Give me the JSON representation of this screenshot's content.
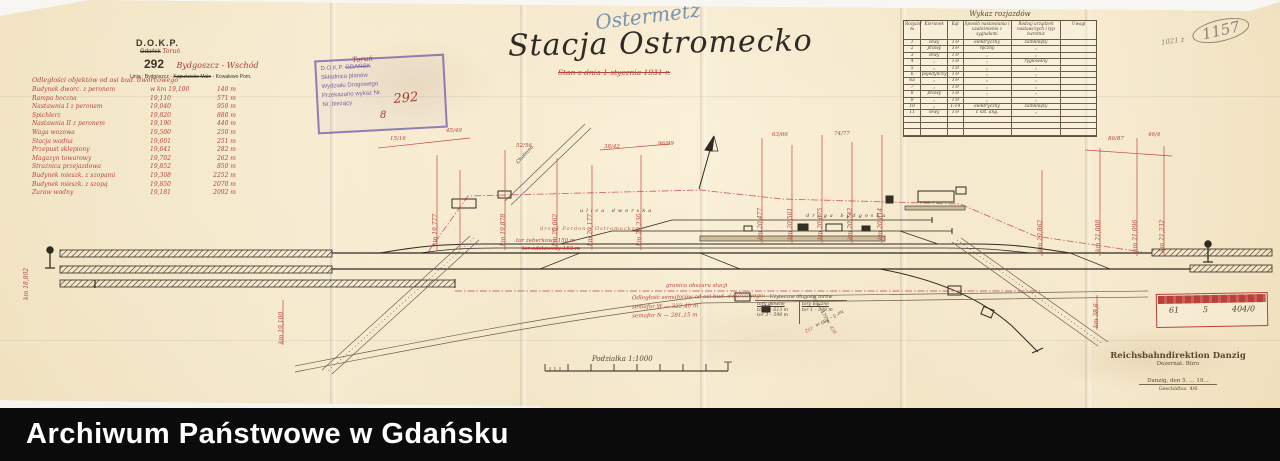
{
  "dokp": {
    "org": "D.O.K.P.",
    "office_old": "Gdańsk",
    "office_new": "Toruń",
    "number": "292",
    "route": "Bydgoszcz - Wschód",
    "line_pre": "Linja : Bydgoszcz -",
    "line_struck": "Kapuścisko Małe",
    "line_post": "- Kowalewo Pom."
  },
  "title": {
    "german": "Ostermetz",
    "main": "Stacja Ostromecko",
    "subtitle": "Stan z dnia 1 stycznia 1931 r."
  },
  "purple_stamp": {
    "l1a": "D.O.K.P.",
    "l1b": "GDAŃSK",
    "l2": "Składnica planów",
    "l3": "Wydziału Drogowego",
    "l4": "Przekazano wykaz Nr.",
    "l5": "Nr. bieżący"
  },
  "archive_note": {
    "prefix": "1021 z",
    "number": "1157"
  },
  "distances": {
    "header": "Odległości objektów od osi bud. dworcowego",
    "rows": [
      {
        "n": "Budynek dworc. z peronem",
        "k": "w km 19,100",
        "m": "140 m"
      },
      {
        "n": "Rampa boczna",
        "k": "19,110",
        "m": "571 m"
      },
      {
        "n": "Nastawnia I z peronem",
        "k": "19,040",
        "m": "950 m"
      },
      {
        "n": "Spichlerz",
        "k": "19,820",
        "m": "880 m"
      },
      {
        "n": "Nastawnia II z peronem",
        "k": "19,190",
        "m": "440 m"
      },
      {
        "n": "Waga wozowa",
        "k": "19,500",
        "m": "250 m"
      },
      {
        "n": "Stacja wodna",
        "k": "19,601",
        "m": "251 m"
      },
      {
        "n": "Przepust sklepiony",
        "k": "19,641",
        "m": "282 m"
      },
      {
        "n": "Magazyn towarowy",
        "k": "19,702",
        "m": "262 m"
      },
      {
        "n": "Strażnica przejazdowa",
        "k": "19,852",
        "m": "850 m"
      },
      {
        "n": "Budynek mieszk. z szopami",
        "k": "19,308",
        "m": "2252 m"
      },
      {
        "n": "Budynek mieszk. z szopą",
        "k": "19,850",
        "m": "2070 m"
      },
      {
        "n": "Żuraw wodny",
        "k": "19,181",
        "m": "2092 m"
      }
    ]
  },
  "turnouts": {
    "title": "Wykaz rozjazdów",
    "columns": [
      "Rozjazd №",
      "Kierunek",
      "Kąt",
      "Sposób nastawiania i uzależnienie z sygnałami",
      "Rodzaj urządzeń nastawczych i typ zwrotnic",
      "Uwagi"
    ],
    "rows": [
      [
        "1",
        "lewy",
        "1:9",
        "elektryczny",
        "zamknięty",
        ""
      ],
      [
        "2",
        "prawy",
        "1:9",
        "ręczny",
        "„",
        ""
      ],
      [
        "3",
        "lewy",
        "1:9",
        "„",
        "„",
        ""
      ],
      [
        "4",
        "„",
        "1:9",
        "„",
        "ryglowany",
        ""
      ],
      [
        "5",
        "„",
        "1:9",
        "„",
        "„",
        ""
      ],
      [
        "6",
        "pojedynczy",
        "1:9",
        "„",
        "„",
        ""
      ],
      [
        "6a",
        "„",
        "1:9",
        "„",
        "„",
        ""
      ],
      [
        "7",
        "„",
        "1:9",
        "„",
        "„",
        ""
      ],
      [
        "8",
        "prawy",
        "1:9",
        "„",
        "„",
        ""
      ],
      [
        "9",
        "„",
        "1:9",
        "„",
        "„",
        ""
      ],
      [
        "10",
        "„",
        "1:14",
        "elektryczny",
        "zamknięty",
        ""
      ],
      [
        "11",
        "lewy",
        "1:9",
        "1 szt. ang.",
        "„",
        ""
      ],
      [
        "",
        "",
        "",
        "",
        "",
        ""
      ],
      [
        "",
        "",
        "",
        "",
        "",
        ""
      ],
      [
        "",
        "",
        "",
        "",
        "",
        ""
      ]
    ]
  },
  "visibility": {
    "l1": "Odległość semaforów od osi bud. dworcowego:",
    "l2": "semafor W  —  322,40 m",
    "l3": "semafor N  —  281,15 m"
  },
  "track_lengths": {
    "title": "Użyteczne długości torów",
    "colA": "tory główne",
    "colB": "tory boczne",
    "rowsA": [
      {
        "t": "tor 2 – 613 m",
        "r": ""
      },
      {
        "t": "tor 3 – 598 m",
        "r": ""
      }
    ],
    "rowsB": [
      {
        "t": "tor 1 – 588 m",
        "r": ""
      },
      {
        "t": "tor 4 – 479 m",
        "r": "420"
      },
      {
        "t": "tor 5 – 180 m",
        "r": "152"
      }
    ]
  },
  "red_stamp": {
    "f1": "61",
    "f2": "5",
    "f3": "404/0"
  },
  "rbd": {
    "l1": "Reichsbahndirektion Danzig",
    "l2": "Dezernat.  Büro",
    "l3": "Danzig, den 5. … 19…",
    "l4": "Geschäftsz. 4/6"
  },
  "scale": {
    "label": "Podziałka 1:1000"
  },
  "footer": {
    "text": "Archiwum Państwowe w Gdańsku"
  },
  "annotations": [
    {
      "t": "km 18,892",
      "x": 24,
      "y": 300,
      "r": -90
    },
    {
      "t": "km 19,100",
      "x": 279,
      "y": 344,
      "r": -90
    },
    {
      "t": "km 19,777",
      "x": 433,
      "y": 246,
      "r": -90
    },
    {
      "t": "45/49",
      "x": 446,
      "y": 128,
      "s": 5.5
    },
    {
      "t": "15/16",
      "x": 390,
      "y": 136,
      "s": 5.5
    },
    {
      "t": "km 19,878",
      "x": 501,
      "y": 246,
      "r": -90
    },
    {
      "t": "52/56",
      "x": 516,
      "y": 143,
      "s": 5.5
    },
    {
      "t": "km 20,062",
      "x": 553,
      "y": 246,
      "r": -90
    },
    {
      "t": "km 20,177",
      "x": 588,
      "y": 246,
      "r": -90
    },
    {
      "t": "38/42",
      "x": 604,
      "y": 144,
      "s": 5.5
    },
    {
      "t": "km 20,236",
      "x": 637,
      "y": 246,
      "r": -90
    },
    {
      "t": "96/99",
      "x": 658,
      "y": 141,
      "s": 5.5
    },
    {
      "t": "km 20,477",
      "x": 758,
      "y": 240,
      "r": -90
    },
    {
      "t": "63/66",
      "x": 772,
      "y": 132,
      "s": 5.5
    },
    {
      "t": "km 20,561",
      "x": 788,
      "y": 240,
      "r": -90
    },
    {
      "t": "km 20,675",
      "x": 818,
      "y": 240,
      "r": -90
    },
    {
      "t": "74/77",
      "x": 834,
      "y": 131,
      "s": 5.5
    },
    {
      "t": "km 20,742",
      "x": 848,
      "y": 240,
      "r": -90
    },
    {
      "t": "km 20,814",
      "x": 878,
      "y": 240,
      "r": -90
    },
    {
      "t": "km 20,862",
      "x": 1038,
      "y": 252,
      "r": -90
    },
    {
      "t": "km 21,008",
      "x": 1096,
      "y": 252,
      "r": -90
    },
    {
      "t": "86/87",
      "x": 1108,
      "y": 136,
      "s": 5.5
    },
    {
      "t": "km 21,096",
      "x": 1133,
      "y": 252,
      "r": -90
    },
    {
      "t": "46/4",
      "x": 1148,
      "y": 132,
      "s": 5.5
    },
    {
      "t": "km 21,232",
      "x": 1160,
      "y": 252,
      "r": -90
    },
    {
      "t": "km 38,6",
      "x": 1094,
      "y": 328,
      "r": -90
    },
    {
      "t": "ulica dworska",
      "x": 580,
      "y": 209,
      "c": "#4a4136",
      "ls": 3,
      "s": 5
    },
    {
      "t": "droga bydgoska",
      "x": 806,
      "y": 214,
      "c": "#4a4136",
      "ls": 3,
      "s": 5
    },
    {
      "t": "droga Fordon – Ostromecko",
      "x": 540,
      "y": 227,
      "c": "#b5564a",
      "s": 5,
      "ls": 1
    },
    {
      "t": "Chełmno",
      "x": 516,
      "y": 162,
      "c": "#4a4136",
      "s": 5,
      "r": -48
    },
    {
      "t": "tor żeberkowy 150 m",
      "x": 516,
      "y": 238,
      "s": 5.5
    },
    {
      "t": "tor odstawczy 150 m",
      "x": 522,
      "y": 246,
      "s": 5.5,
      "strike": true
    },
    {
      "t": "granica obszaru stacji",
      "x": 666,
      "y": 283,
      "s": 5.5
    },
    {
      "t": "Toruń",
      "x": 352,
      "y": 57,
      "c": "#a63d35",
      "s": 7,
      "r": -4
    },
    {
      "t": "292",
      "x": 393,
      "y": 93,
      "c": "#a63d35",
      "s": 13,
      "r": -5
    },
    {
      "t": "8",
      "x": 380,
      "y": 110,
      "c": "#a63d35",
      "s": 10
    }
  ]
}
